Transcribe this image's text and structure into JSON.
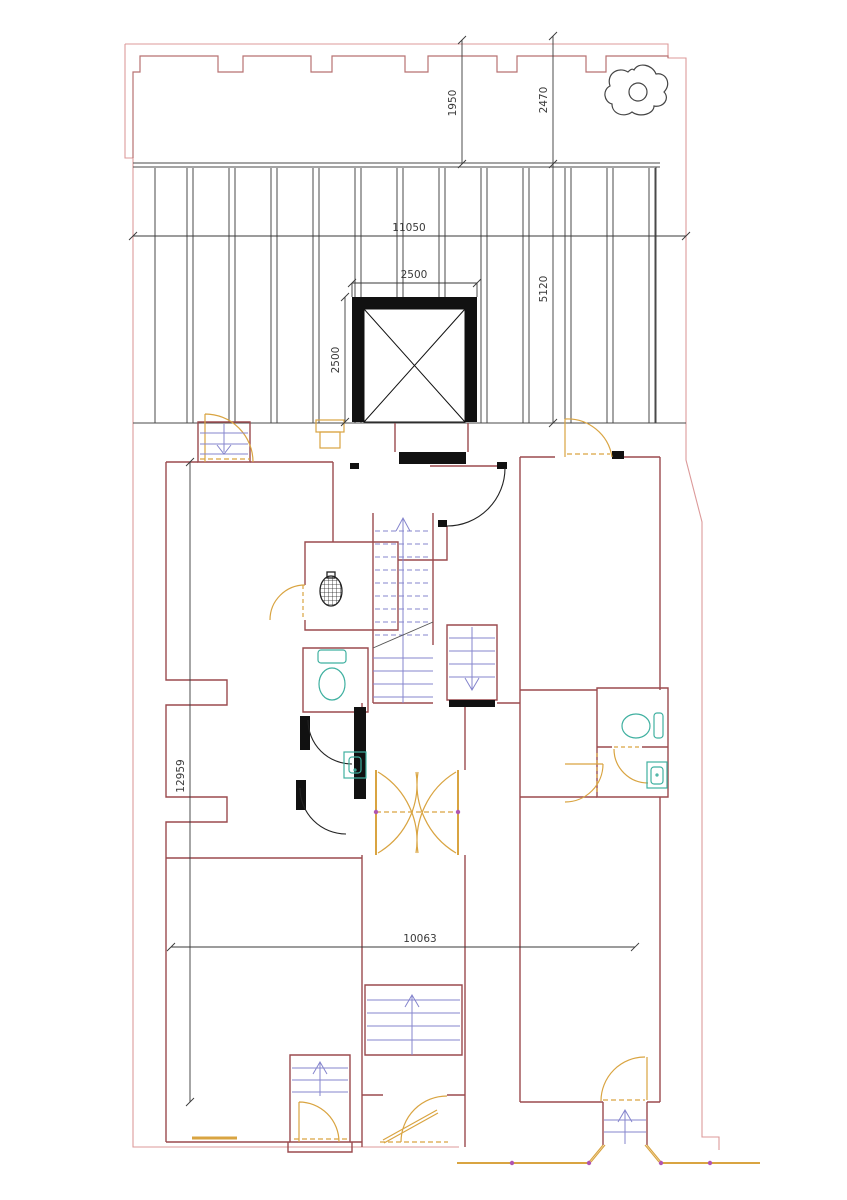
{
  "plan": {
    "type": "architectural-floor-plan",
    "dimensions": {
      "upper_terrace_depth_mid": "1950",
      "upper_terrace_depth_right": "2470",
      "terrace_width": "11050",
      "shaft_width": "2500",
      "shaft_depth": "2500",
      "roof_depth": "5120",
      "left_side_length": "12959",
      "lower_plan_width": "10063"
    },
    "colors": {
      "site_boundary": "#dc9a9a",
      "parapet": "#b87272",
      "wall": "#9b4a4e",
      "heavy_wall": "#111111",
      "door": "#d9a441",
      "stair": "#8585cd",
      "fixture": "#3fb0a0",
      "dimension": "#3a3a3a",
      "roof_lines": "#4a4a4a",
      "hinge": "#b056b0"
    },
    "symbols": {
      "elevator_shaft": "crossed-square",
      "tree": "organic-blob-with-circle",
      "stair_up_arrows": 4,
      "stair_down_arrows": 2
    }
  }
}
